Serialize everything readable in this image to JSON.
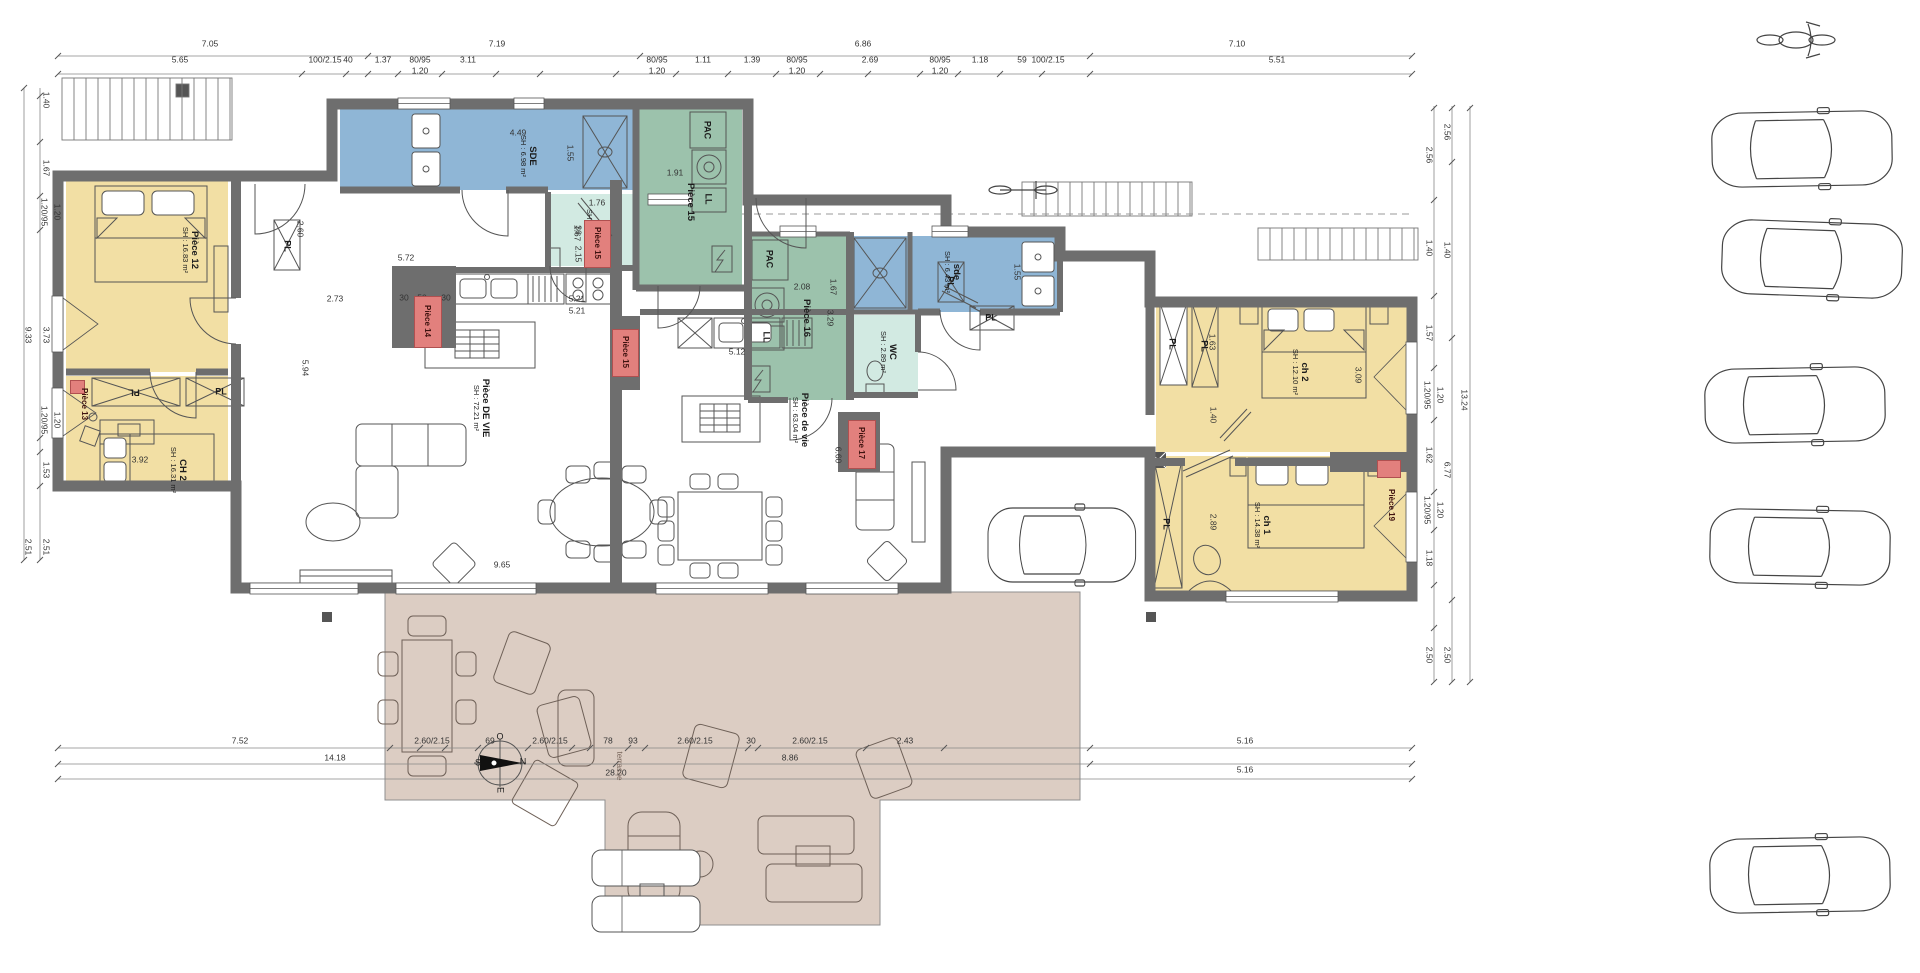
{
  "colors": {
    "bedroom_yellow": "#f2dfa4",
    "bath_blue": "#8fb6d6",
    "wc_teal": "#d2eae2",
    "tech_green": "#9cc2ac",
    "wall_gray": "#6e6e6e",
    "tag_red": "#e2807d",
    "tag_text": "#401310",
    "terrace_tan": "#d6c4b9",
    "dim_text": "#333333"
  },
  "plan": {
    "rooms": [
      {
        "label": "Pièce 12",
        "area": "SH : 16.83 m²",
        "x": 190,
        "y": 250,
        "r": 90
      },
      {
        "label": "CH 2",
        "area": "SH : 16.31 m²",
        "x": 178,
        "y": 470,
        "r": 90
      },
      {
        "label": "SDE",
        "area": "SH : 6.98 m²",
        "x": 528,
        "y": 156,
        "r": 90
      },
      {
        "label": "WC",
        "area": "SH : 2.94 m²",
        "x": 594,
        "y": 230,
        "r": 90
      },
      {
        "label": "Pièce 15",
        "x": 690,
        "y": 202,
        "r": 90
      },
      {
        "label": "Pièce DE VIE",
        "area": "SH : 72.21 m²",
        "x": 481,
        "y": 408,
        "r": 90
      },
      {
        "label": "Pièce 16",
        "x": 806,
        "y": 318,
        "r": 90
      },
      {
        "label": "WC",
        "area": "SH : 2.89 m²",
        "x": 888,
        "y": 352,
        "r": 90
      },
      {
        "label": "sde",
        "area": "SH : 6.43 m²",
        "x": 952,
        "y": 272,
        "r": 90
      },
      {
        "label": "Pièce de vie",
        "area": "SH : 63.04 m²",
        "x": 800,
        "y": 420,
        "r": 90
      },
      {
        "label": "ch 2",
        "area": "SH : 12.10 m²",
        "x": 1300,
        "y": 372,
        "r": 90
      },
      {
        "label": "ch 1",
        "area": "SH : 14.38 m²",
        "x": 1262,
        "y": 525,
        "r": 90
      }
    ],
    "fixtures": [
      {
        "t": "PAC",
        "x": 707,
        "y": 130,
        "r": 90
      },
      {
        "t": "LL",
        "x": 708,
        "y": 199,
        "r": 90
      },
      {
        "t": "PAC",
        "x": 769,
        "y": 259,
        "r": 90
      },
      {
        "t": "LL",
        "x": 766,
        "y": 337,
        "r": 90
      },
      {
        "t": "PL",
        "x": 287,
        "y": 246,
        "r": 90
      },
      {
        "t": "PL",
        "x": 134,
        "y": 392,
        "r": 180
      },
      {
        "t": "PL",
        "x": 221,
        "y": 392,
        "r": 0
      },
      {
        "t": "PL",
        "x": 950,
        "y": 282,
        "r": 90
      },
      {
        "t": "PL",
        "x": 991,
        "y": 318,
        "r": 0
      },
      {
        "t": "PL",
        "x": 1172,
        "y": 344,
        "r": 90
      },
      {
        "t": "PL",
        "x": 1204,
        "y": 346,
        "r": 90
      },
      {
        "t": "PL",
        "x": 1166,
        "y": 524,
        "r": 90
      }
    ],
    "tags": [
      {
        "t": "Pièce 13",
        "x": 84,
        "y": 404,
        "r": 90,
        "bx": 70,
        "by": 380,
        "bw": 13,
        "bh": 12,
        "boxed": false
      },
      {
        "t": "Pièce 14",
        "x": 427,
        "y": 321,
        "r": 90,
        "bx": 414,
        "by": 296,
        "bw": 26,
        "bh": 50,
        "boxed": true
      },
      {
        "t": "Pièce 15",
        "x": 597,
        "y": 243,
        "r": 90,
        "bx": 584,
        "by": 220,
        "bw": 25,
        "bh": 46,
        "boxed": true
      },
      {
        "t": "Pièce 15",
        "x": 625,
        "y": 352,
        "r": 90,
        "bx": 612,
        "by": 329,
        "bw": 25,
        "bh": 46,
        "boxed": true
      },
      {
        "t": "Pièce 17",
        "x": 861,
        "y": 443,
        "r": 90,
        "bx": 848,
        "by": 420,
        "bw": 26,
        "bh": 47,
        "boxed": true
      },
      {
        "t": "Pièce 19",
        "x": 1391,
        "y": 505,
        "r": 90,
        "bx": 1377,
        "by": 460,
        "bw": 22,
        "bh": 16,
        "boxed": false
      }
    ],
    "dims": {
      "top": [
        {
          "t": "7.05",
          "x": 210,
          "y": 44
        },
        {
          "t": "7.19",
          "x": 497,
          "y": 44
        },
        {
          "t": "6.86",
          "x": 863,
          "y": 44
        },
        {
          "t": "7.10",
          "x": 1237,
          "y": 44
        },
        {
          "t": "5.65",
          "x": 180,
          "y": 60
        },
        {
          "t": "100/2.15",
          "x": 325,
          "y": 60
        },
        {
          "t": "40",
          "x": 348,
          "y": 60
        },
        {
          "t": "1.37",
          "x": 383,
          "y": 60
        },
        {
          "t": "80/95",
          "x": 420,
          "y": 60
        },
        {
          "t": "1.20",
          "x": 420,
          "y": 71
        },
        {
          "t": "3.11",
          "x": 468,
          "y": 60
        },
        {
          "t": "80/95",
          "x": 657,
          "y": 60
        },
        {
          "t": "1.20",
          "x": 657,
          "y": 71
        },
        {
          "t": "1.11",
          "x": 703,
          "y": 60
        },
        {
          "t": "1.39",
          "x": 752,
          "y": 60
        },
        {
          "t": "80/95",
          "x": 797,
          "y": 60
        },
        {
          "t": "1.20",
          "x": 797,
          "y": 71
        },
        {
          "t": "2.69",
          "x": 870,
          "y": 60
        },
        {
          "t": "80/95",
          "x": 940,
          "y": 60
        },
        {
          "t": "1.20",
          "x": 940,
          "y": 71
        },
        {
          "t": "1.18",
          "x": 980,
          "y": 60
        },
        {
          "t": "59",
          "x": 1022,
          "y": 60
        },
        {
          "t": "100/2.15",
          "x": 1048,
          "y": 60
        },
        {
          "t": "5.51",
          "x": 1277,
          "y": 60
        }
      ],
      "bottom": [
        {
          "t": "7.52",
          "x": 240,
          "y": 741
        },
        {
          "t": "2.60/2.15",
          "x": 432,
          "y": 741
        },
        {
          "t": "69",
          "x": 490,
          "y": 741
        },
        {
          "t": "2.60/2.15",
          "x": 550,
          "y": 741
        },
        {
          "t": "78",
          "x": 608,
          "y": 741
        },
        {
          "t": "93",
          "x": 633,
          "y": 741
        },
        {
          "t": "2.60/2.15",
          "x": 695,
          "y": 741
        },
        {
          "t": "30",
          "x": 751,
          "y": 741
        },
        {
          "t": "2.60/2.15",
          "x": 810,
          "y": 741
        },
        {
          "t": "2.43",
          "x": 905,
          "y": 741
        },
        {
          "t": "5.16",
          "x": 1245,
          "y": 741
        },
        {
          "t": "14.18",
          "x": 335,
          "y": 758
        },
        {
          "t": "8.86",
          "x": 790,
          "y": 758
        },
        {
          "t": "5.16",
          "x": 1245,
          "y": 770
        },
        {
          "t": "28.20",
          "x": 616,
          "y": 773
        }
      ],
      "left": [
        {
          "t": "1.40",
          "x": 46,
          "y": 100,
          "r": 90
        },
        {
          "t": "1.67",
          "x": 46,
          "y": 168,
          "r": 90
        },
        {
          "t": "1.20/95",
          "x": 44,
          "y": 212,
          "r": 90
        },
        {
          "t": "1.20",
          "x": 57,
          "y": 212,
          "r": 90
        },
        {
          "t": "3.73",
          "x": 46,
          "y": 335,
          "r": 90
        },
        {
          "t": "9.33",
          "x": 28,
          "y": 335,
          "r": 90
        },
        {
          "t": "1.20/95",
          "x": 44,
          "y": 420,
          "r": 90
        },
        {
          "t": "1.20",
          "x": 57,
          "y": 420,
          "r": 90
        },
        {
          "t": "1.53",
          "x": 46,
          "y": 470,
          "r": 90
        },
        {
          "t": "2.51",
          "x": 46,
          "y": 547,
          "r": 90
        },
        {
          "t": "2.51",
          "x": 28,
          "y": 547,
          "r": 90
        }
      ],
      "right": [
        {
          "t": "2.56",
          "x": 1429,
          "y": 155,
          "r": 90
        },
        {
          "t": "2.56",
          "x": 1447,
          "y": 132,
          "r": 90
        },
        {
          "t": "1.40",
          "x": 1429,
          "y": 248,
          "r": 90
        },
        {
          "t": "1.40",
          "x": 1447,
          "y": 250,
          "r": 90
        },
        {
          "t": "1.57",
          "x": 1429,
          "y": 333,
          "r": 90
        },
        {
          "t": "1.20/95",
          "x": 1427,
          "y": 395,
          "r": 90
        },
        {
          "t": "1.20",
          "x": 1440,
          "y": 395,
          "r": 90
        },
        {
          "t": "1.62",
          "x": 1429,
          "y": 455,
          "r": 90
        },
        {
          "t": "1.20/95",
          "x": 1427,
          "y": 510,
          "r": 90
        },
        {
          "t": "1.20",
          "x": 1440,
          "y": 510,
          "r": 90
        },
        {
          "t": "1.18",
          "x": 1429,
          "y": 558,
          "r": 90
        },
        {
          "t": "6.77",
          "x": 1447,
          "y": 470,
          "r": 90
        },
        {
          "t": "13.24",
          "x": 1464,
          "y": 400,
          "r": 90
        },
        {
          "t": "2.50",
          "x": 1429,
          "y": 655,
          "r": 90
        },
        {
          "t": "2.50",
          "x": 1447,
          "y": 655,
          "r": 90
        }
      ],
      "interior": [
        {
          "t": "4.49",
          "x": 518,
          "y": 133
        },
        {
          "t": "1.55",
          "x": 570,
          "y": 153,
          "r": 90
        },
        {
          "t": "1.76",
          "x": 597,
          "y": 203
        },
        {
          "t": "1.67",
          "x": 577,
          "y": 233,
          "r": 90
        },
        {
          "t": "1.91",
          "x": 675,
          "y": 173
        },
        {
          "t": "5.72",
          "x": 406,
          "y": 258
        },
        {
          "t": "2.73",
          "x": 335,
          "y": 299
        },
        {
          "t": "30",
          "x": 404,
          "y": 298
        },
        {
          "t": "50",
          "x": 422,
          "y": 298
        },
        {
          "t": "30",
          "x": 446,
          "y": 298
        },
        {
          "t": "5.21",
          "x": 577,
          "y": 299
        },
        {
          "t": "5.21",
          "x": 577,
          "y": 311
        },
        {
          "t": "2.60",
          "x": 300,
          "y": 229,
          "r": 90
        },
        {
          "t": "5.94",
          "x": 305,
          "y": 368,
          "r": 90
        },
        {
          "t": "9.65",
          "x": 502,
          "y": 565
        },
        {
          "t": "3.92",
          "x": 140,
          "y": 460
        },
        {
          "t": "36",
          "x": 578,
          "y": 230,
          "r": 90
        },
        {
          "t": "2.15",
          "x": 578,
          "y": 254,
          "r": 90
        },
        {
          "t": "2.08",
          "x": 802,
          "y": 287
        },
        {
          "t": "3.29",
          "x": 830,
          "y": 318,
          "r": 90
        },
        {
          "t": "1.55",
          "x": 1017,
          "y": 272,
          "r": 90
        },
        {
          "t": "1.67",
          "x": 833,
          "y": 287,
          "r": 90
        },
        {
          "t": "5.12",
          "x": 737,
          "y": 352
        },
        {
          "t": "6.60",
          "x": 838,
          "y": 455,
          "r": 90
        },
        {
          "t": "1.63",
          "x": 1212,
          "y": 342,
          "r": 90
        },
        {
          "t": "3.09",
          "x": 1358,
          "y": 375,
          "r": 90
        },
        {
          "t": "1.40",
          "x": 1213,
          "y": 415,
          "r": 90
        },
        {
          "t": "2.89",
          "x": 1213,
          "y": 522,
          "r": 90
        }
      ]
    },
    "compass": {
      "letters": [
        {
          "t": "O",
          "x": 500,
          "y": 737
        },
        {
          "t": "S",
          "x": 478,
          "y": 763
        },
        {
          "t": "N",
          "x": 523,
          "y": 762
        },
        {
          "t": "E",
          "x": 500,
          "y": 790,
          "r": 90
        }
      ]
    },
    "terrace_label": {
      "t": "terrasse",
      "x": 619,
      "y": 766,
      "r": 90
    }
  }
}
